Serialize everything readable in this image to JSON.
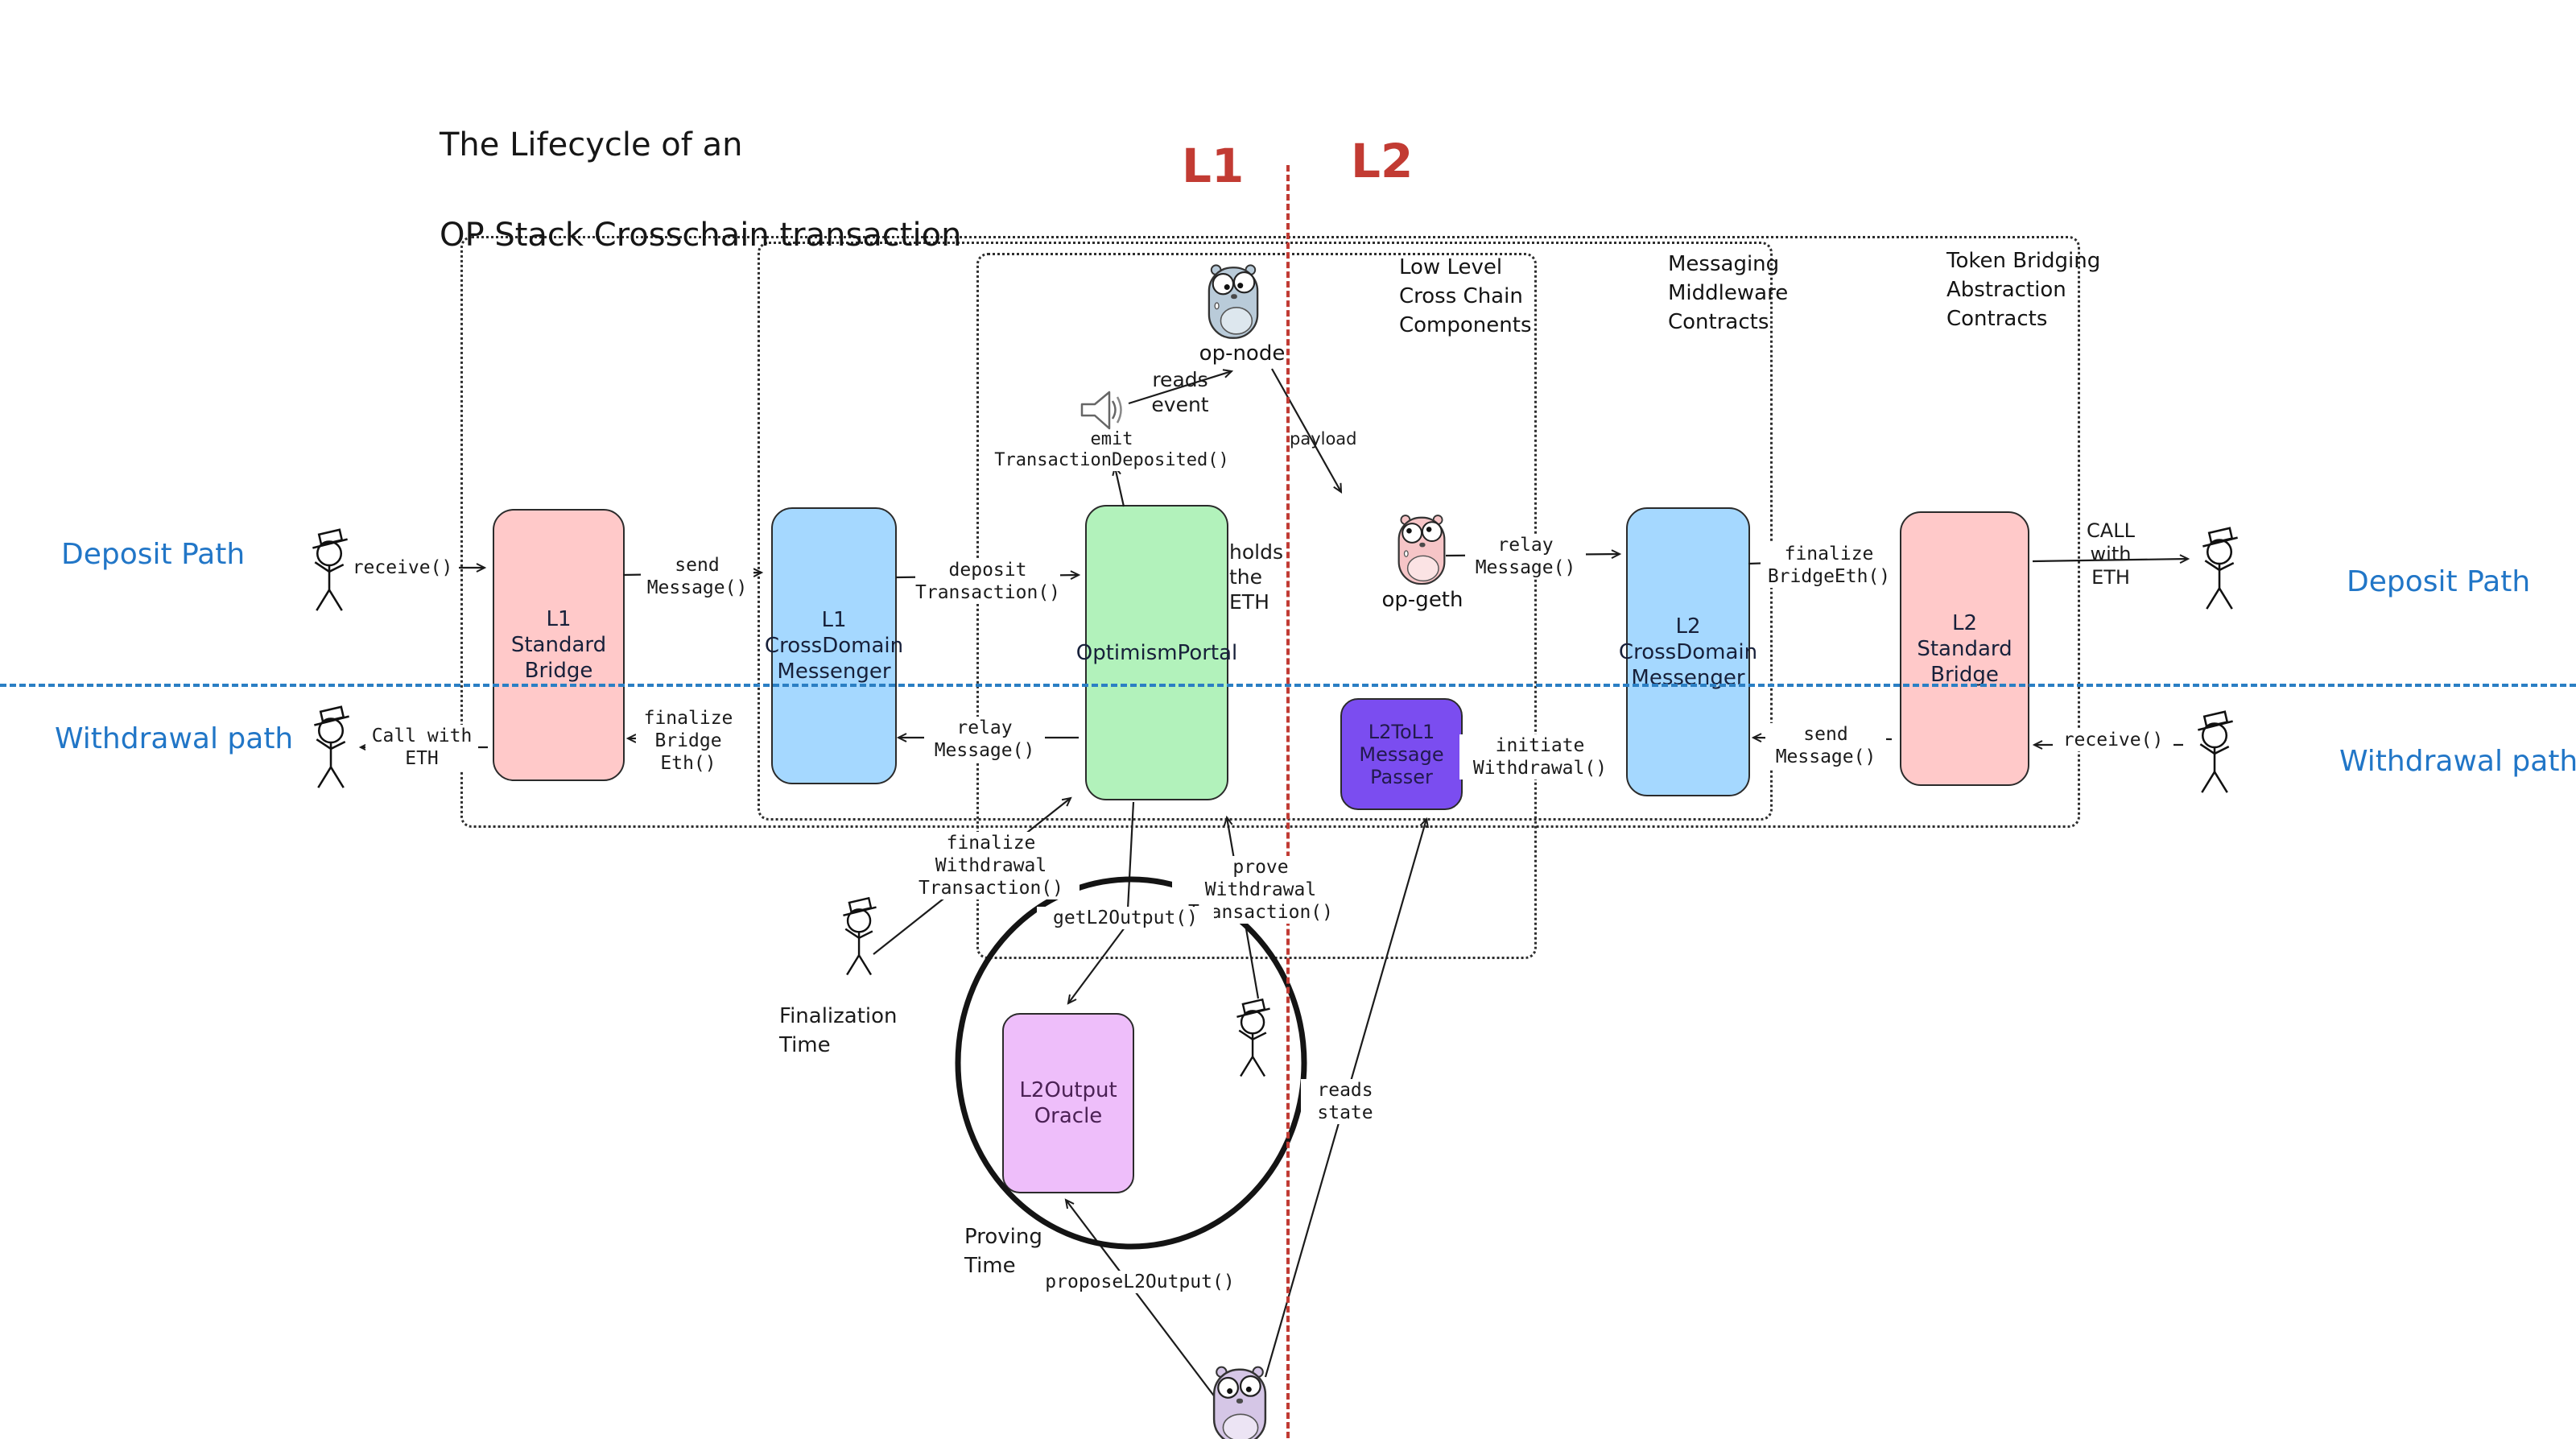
{
  "title": {
    "line1": "The Lifecycle of an",
    "line2": "OP Stack Crosschain transaction"
  },
  "lanes": {
    "l1": "L1",
    "l2": "L2",
    "deposit_left": "Deposit Path",
    "withdrawal_left": "Withdrawal path",
    "deposit_right": "Deposit Path",
    "withdrawal_right": "Withdrawal path"
  },
  "groups": {
    "low_level": "Low Level\nCross Chain\nComponents",
    "messaging": "Messaging\nMiddleware\nContracts",
    "token_bridging": "Token Bridging\nAbstraction\nContracts"
  },
  "nodes": {
    "l1_standard_bridge": {
      "label": "L1\nStandard\nBridge",
      "color": "#ffc9c9"
    },
    "l1_crossdomain_messenger": {
      "label": "L1\nCrossDomain\nMessenger",
      "color": "#a5d8ff"
    },
    "optimism_portal": {
      "label": "OptimismPortal",
      "color": "#b2f2bb"
    },
    "l2tol1_message_passer": {
      "label": "L2ToL1\nMessage\nPasser",
      "color": "#7b4df0"
    },
    "l2_crossdomain_messenger": {
      "label": "L2\nCrossDomain\nMessenger",
      "color": "#a5d8ff"
    },
    "l2_standard_bridge": {
      "label": "L2\nStandard\nBridge",
      "color": "#ffc9c9"
    },
    "l2output_oracle": {
      "label": "L2Output\nOracle",
      "color": "#eebefa"
    }
  },
  "actors": {
    "op_node": "op-node",
    "op_geth": "op-geth",
    "op_proposer": "op-proposer"
  },
  "edges": {
    "receive_deposit": "receive()",
    "send_message_deposit": "send\nMessage()",
    "deposit_transaction": "deposit\nTransaction()",
    "emit_transaction_deposited": "emit\nTransactionDeposited()",
    "reads_event": "reads\nevent",
    "payload": "payload",
    "relay_message_deposit": "relay\nMessage()",
    "finalize_bridge_eth_deposit": "finalize\nBridgeEth()",
    "call_with_eth_deposit": "CALL\nwith\nETH",
    "receive_withdrawal": "receive()",
    "send_message_withdrawal": "send\nMessage()",
    "initiate_withdrawal": "initiate\nWithdrawal()",
    "relay_message_withdrawal": "relay\nMessage()",
    "finalize_bridge_eth_withdrawal": "finalize\nBridge\nEth()",
    "call_with_eth_withdrawal": "Call with\nETH",
    "finalize_withdrawal_transaction": "finalize\nWithdrawal\nTransaction()",
    "prove_withdrawal_transaction": "prove\nWithdrawal\nTransaction()",
    "get_l2_output": "getL2Output()",
    "propose_l2_output": "proposeL2Output()",
    "reads_state": "reads\nstate"
  },
  "notes": {
    "holds_the_eth": "holds\nthe\nETH",
    "finalization_time": "Finalization\nTime",
    "proving_time": "Proving\nTime"
  },
  "colors": {
    "lane_label_blue": "#2176c7",
    "chain_label_red": "#c23b33",
    "divider_blue": "#2b7fc4",
    "divider_red": "#c13b34",
    "box_pink": "#ffc9c9",
    "box_blue": "#a5d8ff",
    "box_green": "#b2f2bb",
    "box_violet": "#7b4df0",
    "box_light_purple": "#eebefa",
    "gopher_blue": "#b9cbd9",
    "gopher_pink": "#f6c5c7",
    "gopher_lavender": "#d5c6e6",
    "ink": "#1b1b1b"
  }
}
